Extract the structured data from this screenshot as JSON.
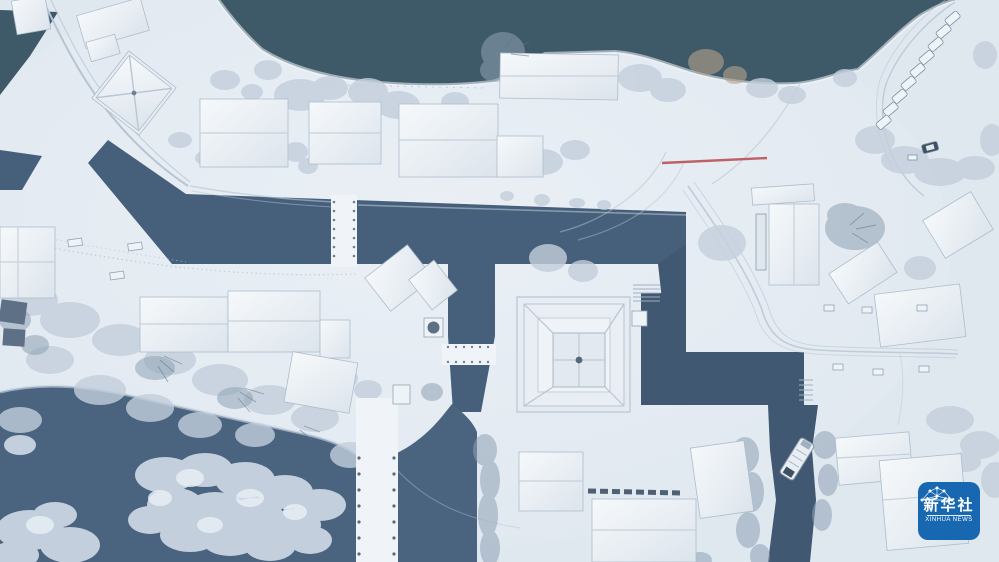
{
  "watermark": {
    "cn": "新华社",
    "en": "XINHUA NEWS"
  },
  "palette": {
    "snow": "#dfe7ef",
    "snow-bright": "#f0f4f9",
    "lake": "#3e5967",
    "canal": "#46607b",
    "canal-dark": "#405871",
    "pond": "#4a6480",
    "tree": "#c3cfdc",
    "tree-dark": "#8fa2b5",
    "roof-edge": "#aebdcc",
    "ridge": "#c6d1dc",
    "track": "#b7c4d2",
    "railing-red": "#c05f66",
    "boat-dark": "#3e5064",
    "logo-blue": "#1767b1",
    "logo-text": "#ffffff"
  }
}
